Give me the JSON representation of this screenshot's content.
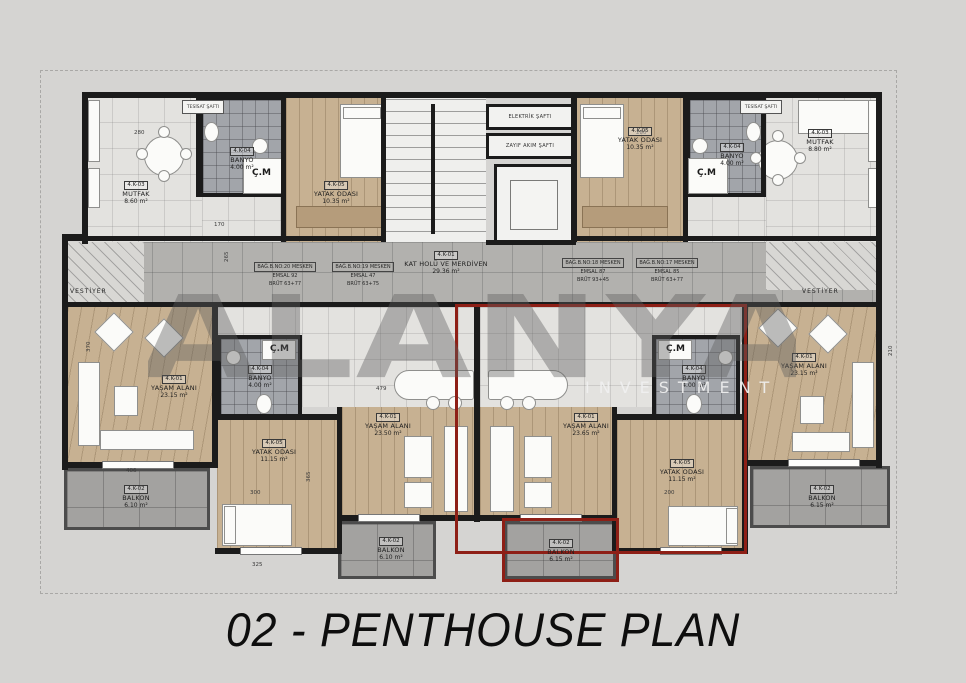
{
  "title": "02 - PENTHOUSE PLAN",
  "watermark": {
    "word": "ALANYA",
    "sub": "INVESTMENT"
  },
  "colors": {
    "background": "#d5d4d2",
    "wall": "#1b1b1b",
    "wood_floor": "#c7b192",
    "tile_light": "#e3e2df",
    "tile_corridor": "#b2b1ae",
    "tile_bath": "#a2a5aa",
    "balcony": "#a3a2a0",
    "red_unit_outline": "#8e1f16"
  },
  "core": {
    "kat_holu": {
      "code": "4.K-01",
      "name": "KAT HOLÜ VE MERDİVEN",
      "area": "29.36 m²"
    },
    "elektrik_safti": "ELEKTRİK ŞAFTI",
    "zayif_akim_safti": "ZAYIF AKIM ŞAFTI",
    "tesisat_safti_left": "TESİSAT ŞAFTI",
    "tesisat_safti_right": "TESİSAT ŞAFTI"
  },
  "vestiyer_left": "VESTİYER",
  "vestiyer_right": "VESTİYER",
  "rooms": {
    "tl_mutfak": {
      "code": "4.K-03",
      "name": "MUTFAK",
      "area": "8.60 m²"
    },
    "tl_banyo": {
      "code": "4.K-04",
      "name": "BANYO",
      "area": "4.00 m²"
    },
    "tl_cm": "Ç.M",
    "tl_yatak": {
      "code": "4.K-05",
      "name": "YATAK ODASI",
      "area": "10.35 m²"
    },
    "tr_yatak": {
      "code": "4.K-05",
      "name": "YATAK ODASI",
      "area": "10.35 m²"
    },
    "tr_banyo": {
      "code": "4.K-04",
      "name": "BANYO",
      "area": "4.00 m²"
    },
    "tr_cm": "Ç.M",
    "tr_mutfak": {
      "code": "4.K-03",
      "name": "MUTFAK",
      "area": "8.80 m²"
    },
    "bl_yasam": {
      "code": "4.K-01",
      "name": "YAŞAM ALANI",
      "area": "23.15 m²"
    },
    "bl_balkon": {
      "code": "4.K-02",
      "name": "BALKON",
      "area": "6.10 m²"
    },
    "ml_yatak": {
      "code": "4.K-05",
      "name": "YATAK ODASI",
      "area": "11.15 m²"
    },
    "ml_banyo": {
      "code": "4.K-04",
      "name": "BANYO",
      "area": "4.00 m²"
    },
    "ml_cm": "Ç.M",
    "ml_yasam": {
      "code": "4.K-01",
      "name": "YAŞAM ALANI",
      "area": "23.50 m²"
    },
    "ml_balkon": {
      "code": "4.K-02",
      "name": "BALKON",
      "area": "6.10 m²"
    },
    "mr_yasam": {
      "code": "4.K-01",
      "name": "YAŞAM ALANI",
      "area": "23.65 m²"
    },
    "mr_yatak": {
      "code": "4.K-05",
      "name": "YATAK ODASI",
      "area": "11.15 m²"
    },
    "mr_banyo": {
      "code": "4.K-04",
      "name": "BANYO",
      "area": "4.00 m²"
    },
    "mr_cm": "Ç.M",
    "mr_balkon": {
      "code": "4.K-02",
      "name": "BALKON",
      "area": "6.15 m²"
    },
    "br_yasam": {
      "code": "4.K-01",
      "name": "YAŞAM ALANI",
      "area": "23.15 m²"
    },
    "br_balkon": {
      "code": "4.K-02",
      "name": "BALKON",
      "area": "6.15 m²"
    }
  },
  "annotations": [
    {
      "l1": "BAĞ.B.NO:20 MESKEN",
      "l2": "EMSAL 92",
      "l3": "BRÜT 63+77"
    },
    {
      "l1": "BAĞ.B.NO:19 MESKEN",
      "l2": "EMSAL 47",
      "l3": "BRÜT 63+75"
    },
    {
      "l1": "BAĞ.B.NO:18 MESKEN",
      "l2": "EMSAL 87",
      "l3": "BRÜT 93+45"
    },
    {
      "l1": "BAĞ.B.NO:17 MESKEN",
      "l2": "EMSAL 85",
      "l3": "BRÜT 63+77"
    }
  ],
  "dims": {
    "d1": "280",
    "d2": "170",
    "d3": "265",
    "d4": "280",
    "d5": "479",
    "d6": "370",
    "d7": "406",
    "d8": "365",
    "d9": "300",
    "d10": "325",
    "d11": "210",
    "d12": "200"
  }
}
